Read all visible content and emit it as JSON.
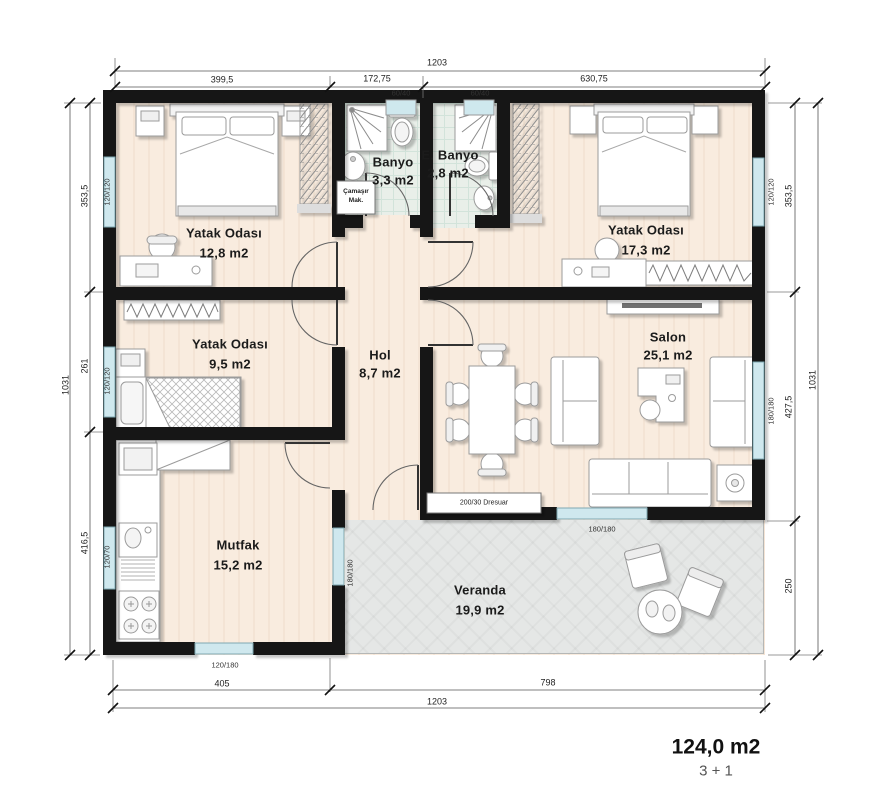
{
  "colors": {
    "wall": "#161616",
    "window_glass": "#cfe8ee",
    "window_frame": "#7fa9b3",
    "floor_wood": "#f9ecdf",
    "floor_bath": "#e9efe9",
    "floor_veranda": "#e5e7e6",
    "furniture_stroke": "#9b9b9b",
    "dimension_line": "#555555"
  },
  "plan": {
    "rooms": [
      {
        "name": "Yatak Odası",
        "area": "12,8 m2"
      },
      {
        "name": "Banyo",
        "area": "3,3 m2"
      },
      {
        "name": "E. Banyo",
        "area": "2,8 m2"
      },
      {
        "name": "Yatak Odası",
        "area": "17,3 m2"
      },
      {
        "name": "Yatak Odası",
        "area": "9,5 m2"
      },
      {
        "name": "Hol",
        "area": "8,7 m2"
      },
      {
        "name": "Salon",
        "area": "25,1 m2"
      },
      {
        "name": "Mutfak",
        "area": "15,2 m2"
      },
      {
        "name": "Veranda",
        "area": "19,9 m2"
      }
    ],
    "summary": {
      "total_area": "124,0 m2",
      "layout_type": "3 + 1"
    },
    "fixtures": {
      "washing_machine_line1": "Çamaşır",
      "washing_machine_line2": "Mak.",
      "dresser": "200/30 Dresuar"
    },
    "dimensions": {
      "top": {
        "overall": "1203",
        "segments": [
          "399,5",
          "172,75",
          "630,75"
        ],
        "windows": [
          "60/40",
          "60/40"
        ]
      },
      "bottom": {
        "overall": "1203",
        "segments": [
          "405",
          "798"
        ]
      },
      "left": {
        "overall": "1031",
        "segments": [
          "353,5",
          "261",
          "416,5"
        ],
        "windows": [
          "120/120",
          "120/120",
          "120/70"
        ]
      },
      "right": {
        "overall": "1031",
        "segments": [
          "353,5",
          "427,5",
          "250"
        ],
        "windows": [
          "120/120",
          "180/180"
        ]
      },
      "interior_windows": [
        "180/180",
        "120/180",
        "180/180"
      ]
    }
  },
  "labels": [
    {
      "n": "room-yatak1-name",
      "t": "Yatak Odası",
      "x": 224,
      "y": 233,
      "c": "room"
    },
    {
      "n": "room-yatak1-area",
      "t": "12,8 m2",
      "x": 224,
      "y": 253,
      "c": "room"
    },
    {
      "n": "room-banyo-name",
      "t": "Banyo",
      "x": 393,
      "y": 162,
      "c": "room"
    },
    {
      "n": "room-banyo-area",
      "t": "3,3 m2",
      "x": 393,
      "y": 180,
      "c": "room"
    },
    {
      "n": "room-ebanyo-name",
      "t": "E. Banyo",
      "x": 450,
      "y": 155,
      "c": "room"
    },
    {
      "n": "room-ebanyo-area",
      "t": "2,8 m2",
      "x": 448,
      "y": 173,
      "c": "room"
    },
    {
      "n": "room-yatak2-name",
      "t": "Yatak Odası",
      "x": 646,
      "y": 230,
      "c": "room"
    },
    {
      "n": "room-yatak2-area",
      "t": "17,3 m2",
      "x": 646,
      "y": 250,
      "c": "room"
    },
    {
      "n": "room-yatak3-name",
      "t": "Yatak Odası",
      "x": 230,
      "y": 344,
      "c": "room"
    },
    {
      "n": "room-yatak3-area",
      "t": "9,5 m2",
      "x": 230,
      "y": 364,
      "c": "room"
    },
    {
      "n": "room-hol-name",
      "t": "Hol",
      "x": 380,
      "y": 355,
      "c": "room"
    },
    {
      "n": "room-hol-area",
      "t": "8,7 m2",
      "x": 380,
      "y": 373,
      "c": "room"
    },
    {
      "n": "room-salon-name",
      "t": "Salon",
      "x": 668,
      "y": 337,
      "c": "room"
    },
    {
      "n": "room-salon-area",
      "t": "25,1 m2",
      "x": 668,
      "y": 355,
      "c": "room"
    },
    {
      "n": "room-mutfak-name",
      "t": "Mutfak",
      "x": 238,
      "y": 545,
      "c": "room"
    },
    {
      "n": "room-mutfak-area",
      "t": "15,2 m2",
      "x": 238,
      "y": 565,
      "c": "room"
    },
    {
      "n": "room-veranda-name",
      "t": "Veranda",
      "x": 480,
      "y": 590,
      "c": "room"
    },
    {
      "n": "room-veranda-area",
      "t": "19,9 m2",
      "x": 480,
      "y": 610,
      "c": "room"
    },
    {
      "n": "dim-top-overall",
      "t": "1203",
      "x": 437,
      "y": 63,
      "c": "dim"
    },
    {
      "n": "dim-top-seg1",
      "t": "399,5",
      "x": 222,
      "y": 80,
      "c": "dim"
    },
    {
      "n": "dim-top-seg2",
      "t": "172,75",
      "x": 377,
      "y": 79,
      "c": "dim"
    },
    {
      "n": "dim-top-seg3",
      "t": "630,75",
      "x": 594,
      "y": 79,
      "c": "dim"
    },
    {
      "n": "win-top-1",
      "t": "60/40",
      "x": 401,
      "y": 93,
      "c": "win"
    },
    {
      "n": "win-top-2",
      "t": "60/40",
      "x": 480,
      "y": 93,
      "c": "win"
    },
    {
      "n": "dim-bottom-seg1",
      "t": "405",
      "x": 222,
      "y": 684,
      "c": "dim"
    },
    {
      "n": "dim-bottom-seg2",
      "t": "798",
      "x": 548,
      "y": 683,
      "c": "dim"
    },
    {
      "n": "dim-bottom-overall",
      "t": "1203",
      "x": 437,
      "y": 702,
      "c": "dim"
    },
    {
      "n": "dim-left-overall",
      "t": "1031",
      "x": 66,
      "y": 385,
      "c": "dimr"
    },
    {
      "n": "dim-left-seg1",
      "t": "353,5",
      "x": 85,
      "y": 196,
      "c": "dimr"
    },
    {
      "n": "dim-left-seg2",
      "t": "261",
      "x": 85,
      "y": 366,
      "c": "dimr"
    },
    {
      "n": "dim-left-seg3",
      "t": "416,5",
      "x": 85,
      "y": 543,
      "c": "dimr"
    },
    {
      "n": "win-left-1",
      "t": "120/120",
      "x": 107,
      "y": 192,
      "c": "winr"
    },
    {
      "n": "win-left-2",
      "t": "120/120",
      "x": 107,
      "y": 381,
      "c": "winr"
    },
    {
      "n": "win-left-3",
      "t": "120/70",
      "x": 107,
      "y": 557,
      "c": "winr"
    },
    {
      "n": "dim-right-seg1",
      "t": "353,5",
      "x": 789,
      "y": 196,
      "c": "dimr"
    },
    {
      "n": "dim-right-seg2",
      "t": "427,5",
      "x": 789,
      "y": 407,
      "c": "dimr"
    },
    {
      "n": "dim-right-seg3",
      "t": "250",
      "x": 789,
      "y": 586,
      "c": "dimr"
    },
    {
      "n": "dim-right-overall",
      "t": "1031",
      "x": 813,
      "y": 380,
      "c": "dimr"
    },
    {
      "n": "win-right-1",
      "t": "120/120",
      "x": 771,
      "y": 192,
      "c": "winr"
    },
    {
      "n": "win-right-2",
      "t": "180/180",
      "x": 771,
      "y": 411,
      "c": "winr"
    },
    {
      "n": "win-salon-bottom",
      "t": "180/180",
      "x": 602,
      "y": 529,
      "c": "win"
    },
    {
      "n": "win-mutfak-bottom",
      "t": "120/180",
      "x": 225,
      "y": 665,
      "c": "win"
    },
    {
      "n": "win-mutfak-veranda",
      "t": "180/180",
      "x": 350,
      "y": 573,
      "c": "winr"
    },
    {
      "n": "fixture-dresuar-label",
      "t": "200/30 Dresuar",
      "x": 484,
      "y": 503,
      "c": "tiny"
    },
    {
      "n": "fixture-washer-line1",
      "t": "Çamaşır",
      "x": 356,
      "y": 192,
      "c": "tiny2"
    },
    {
      "n": "fixture-washer-line2",
      "t": "Mak.",
      "x": 356,
      "y": 201,
      "c": "tiny2"
    },
    {
      "n": "total-area",
      "t": "124,0 m2",
      "x": 716,
      "y": 747,
      "c": "big"
    },
    {
      "n": "layout-type",
      "t": "3 + 1",
      "x": 716,
      "y": 771,
      "c": "sub"
    }
  ]
}
